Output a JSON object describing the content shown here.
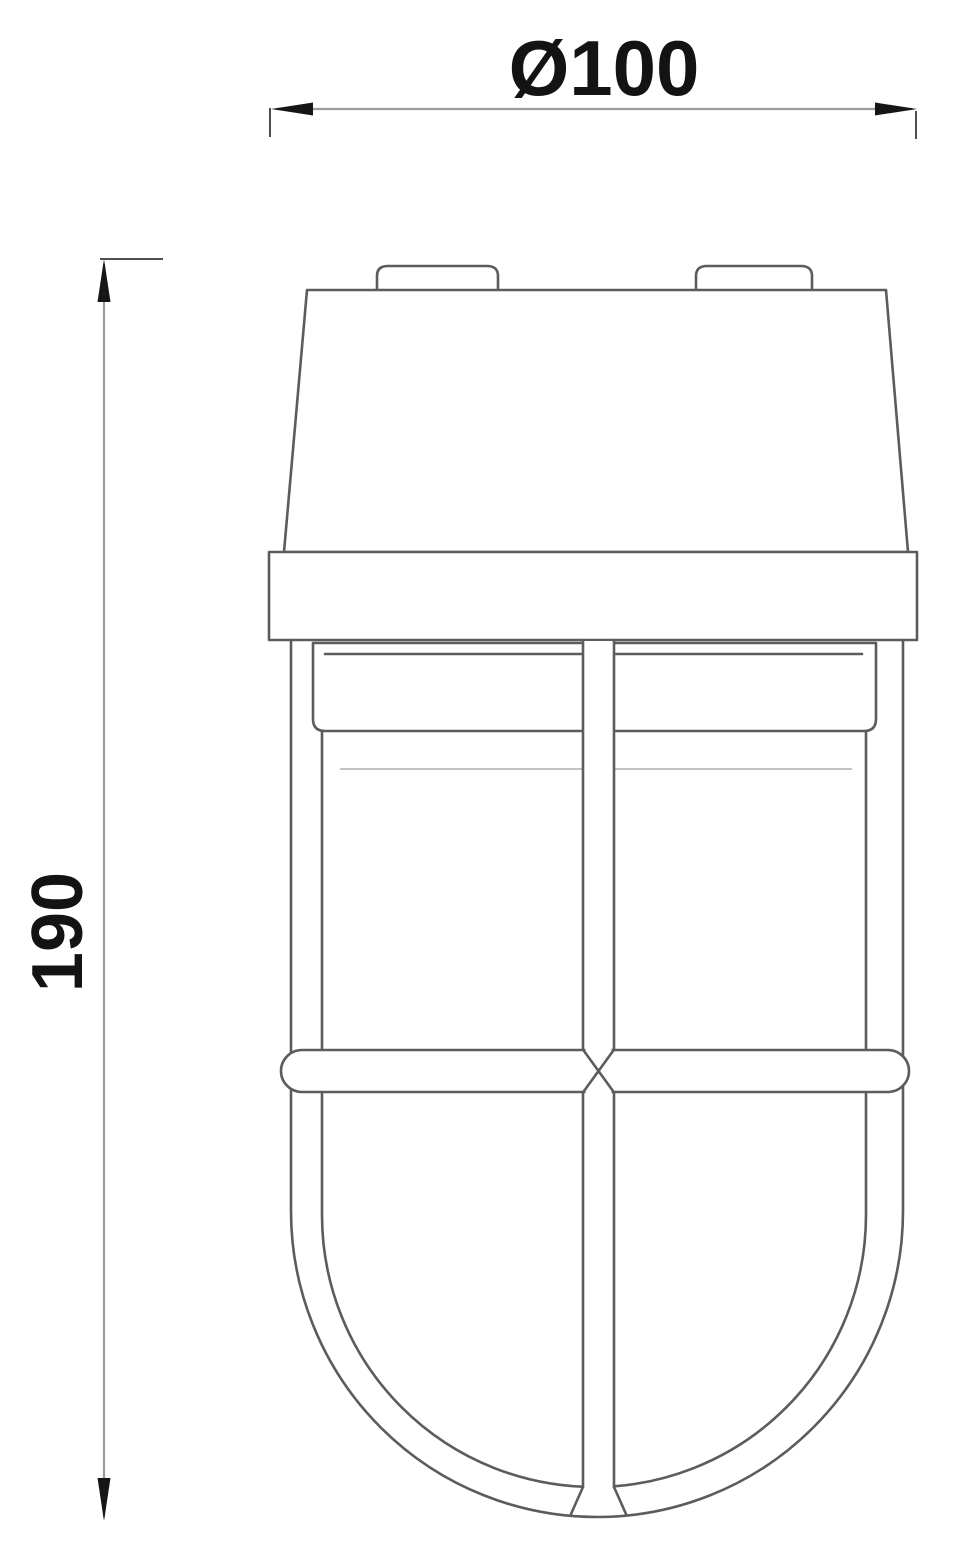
{
  "figure": {
    "name": "caged-lamp-technical-drawing",
    "background_color": "#ffffff",
    "outline_color": "#5c5c5c",
    "dimension_line_color": "#9b9b9b",
    "annotation_color": "#131313"
  },
  "dimensions": {
    "diameter": {
      "label": "Ø100",
      "orientation": "horizontal"
    },
    "height": {
      "label": "190",
      "orientation": "vertical"
    }
  }
}
